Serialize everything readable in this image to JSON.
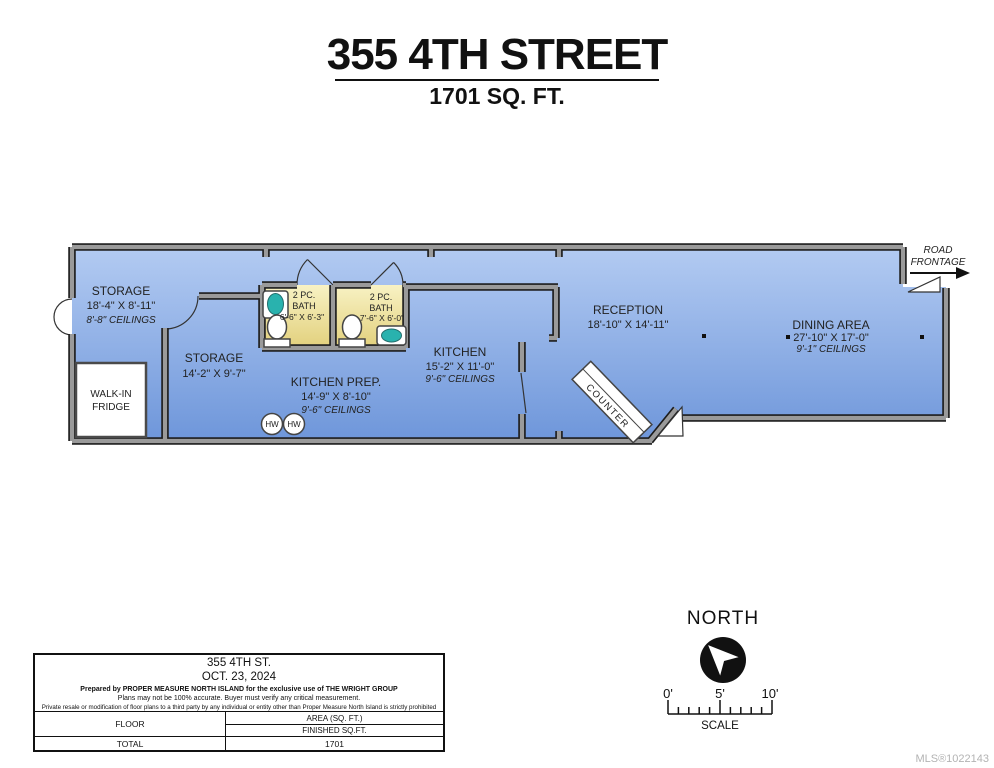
{
  "title": {
    "address": "355 4TH STREET",
    "area": "1701 SQ. FT."
  },
  "floorplan": {
    "road_frontage": {
      "line1": "ROAD",
      "line2": "FRONTAGE"
    },
    "rooms": {
      "storage_main": {
        "name": "STORAGE",
        "dims": "18'-4\" X 8'-11\"",
        "ceilings": "8'-8\" CEILINGS"
      },
      "storage_small": {
        "name": "STORAGE",
        "dims": "14'-2\" X 9'-7\""
      },
      "bath_left": {
        "line1": "2 PC.",
        "line2": "BATH",
        "dims": "6'-6\" X 6'-3\""
      },
      "bath_right": {
        "line1": "2 PC.",
        "line2": "BATH",
        "dims": "7'-6\" X 6'-0\""
      },
      "kitchen_prep": {
        "name": "KITCHEN PREP.",
        "dims": "14'-9\" X 8'-10\"",
        "ceilings": "9'-6\" CEILINGS"
      },
      "kitchen": {
        "name": "KITCHEN",
        "dims": "15'-2\" X 11'-0\"",
        "ceilings": "9'-6\" CEILINGS"
      },
      "reception": {
        "name": "RECEPTION",
        "dims": "18'-10\" X 14'-11\""
      },
      "dining": {
        "name": "DINING AREA",
        "dims": "27'-10\" X 17'-0\"",
        "ceilings": "9'-1\" CEILINGS"
      }
    },
    "fixtures": {
      "walk_in_line1": "WALK-IN",
      "walk_in_line2": "FRIDGE",
      "counter": "COUNTER",
      "hot_water": "HW"
    }
  },
  "info_box": {
    "address": "355 4TH ST.",
    "date": "OCT. 23, 2024",
    "prepared_by": "Prepared by PROPER MEASURE NORTH ISLAND for the exclusive use of THE WRIGHT GROUP",
    "accuracy": "Plans may not be 100% accurate.  Buyer must verify any critical measurement.",
    "disclaimer": "Private resale  or modification of floor plans to a third party by any individual or entity other than Proper Measure North Island is strictly prohibited",
    "table": {
      "floor_label": "FLOOR",
      "area_header": "AREA (SQ. FT.)",
      "finished_header": "FINISHED SQ.FT.",
      "total_label": "TOTAL",
      "total_value": "1701"
    }
  },
  "compass": {
    "label": "NORTH"
  },
  "scale_bar": {
    "tick0": "0'",
    "tick5": "5'",
    "tick10": "10'",
    "label": "SCALE"
  },
  "watermark": "MLS®1022143",
  "colors": {
    "floor_top": "#b3cbf2",
    "floor_bottom": "#6e96da",
    "bath_top": "#f8f2c4",
    "bath_bottom": "#e2d07c",
    "wall_fill": "#9a9a9a",
    "wall_outline": "#1c1c1c",
    "sink_teal": "#29b2ae",
    "watermark_gray": "#b3b3b3"
  }
}
